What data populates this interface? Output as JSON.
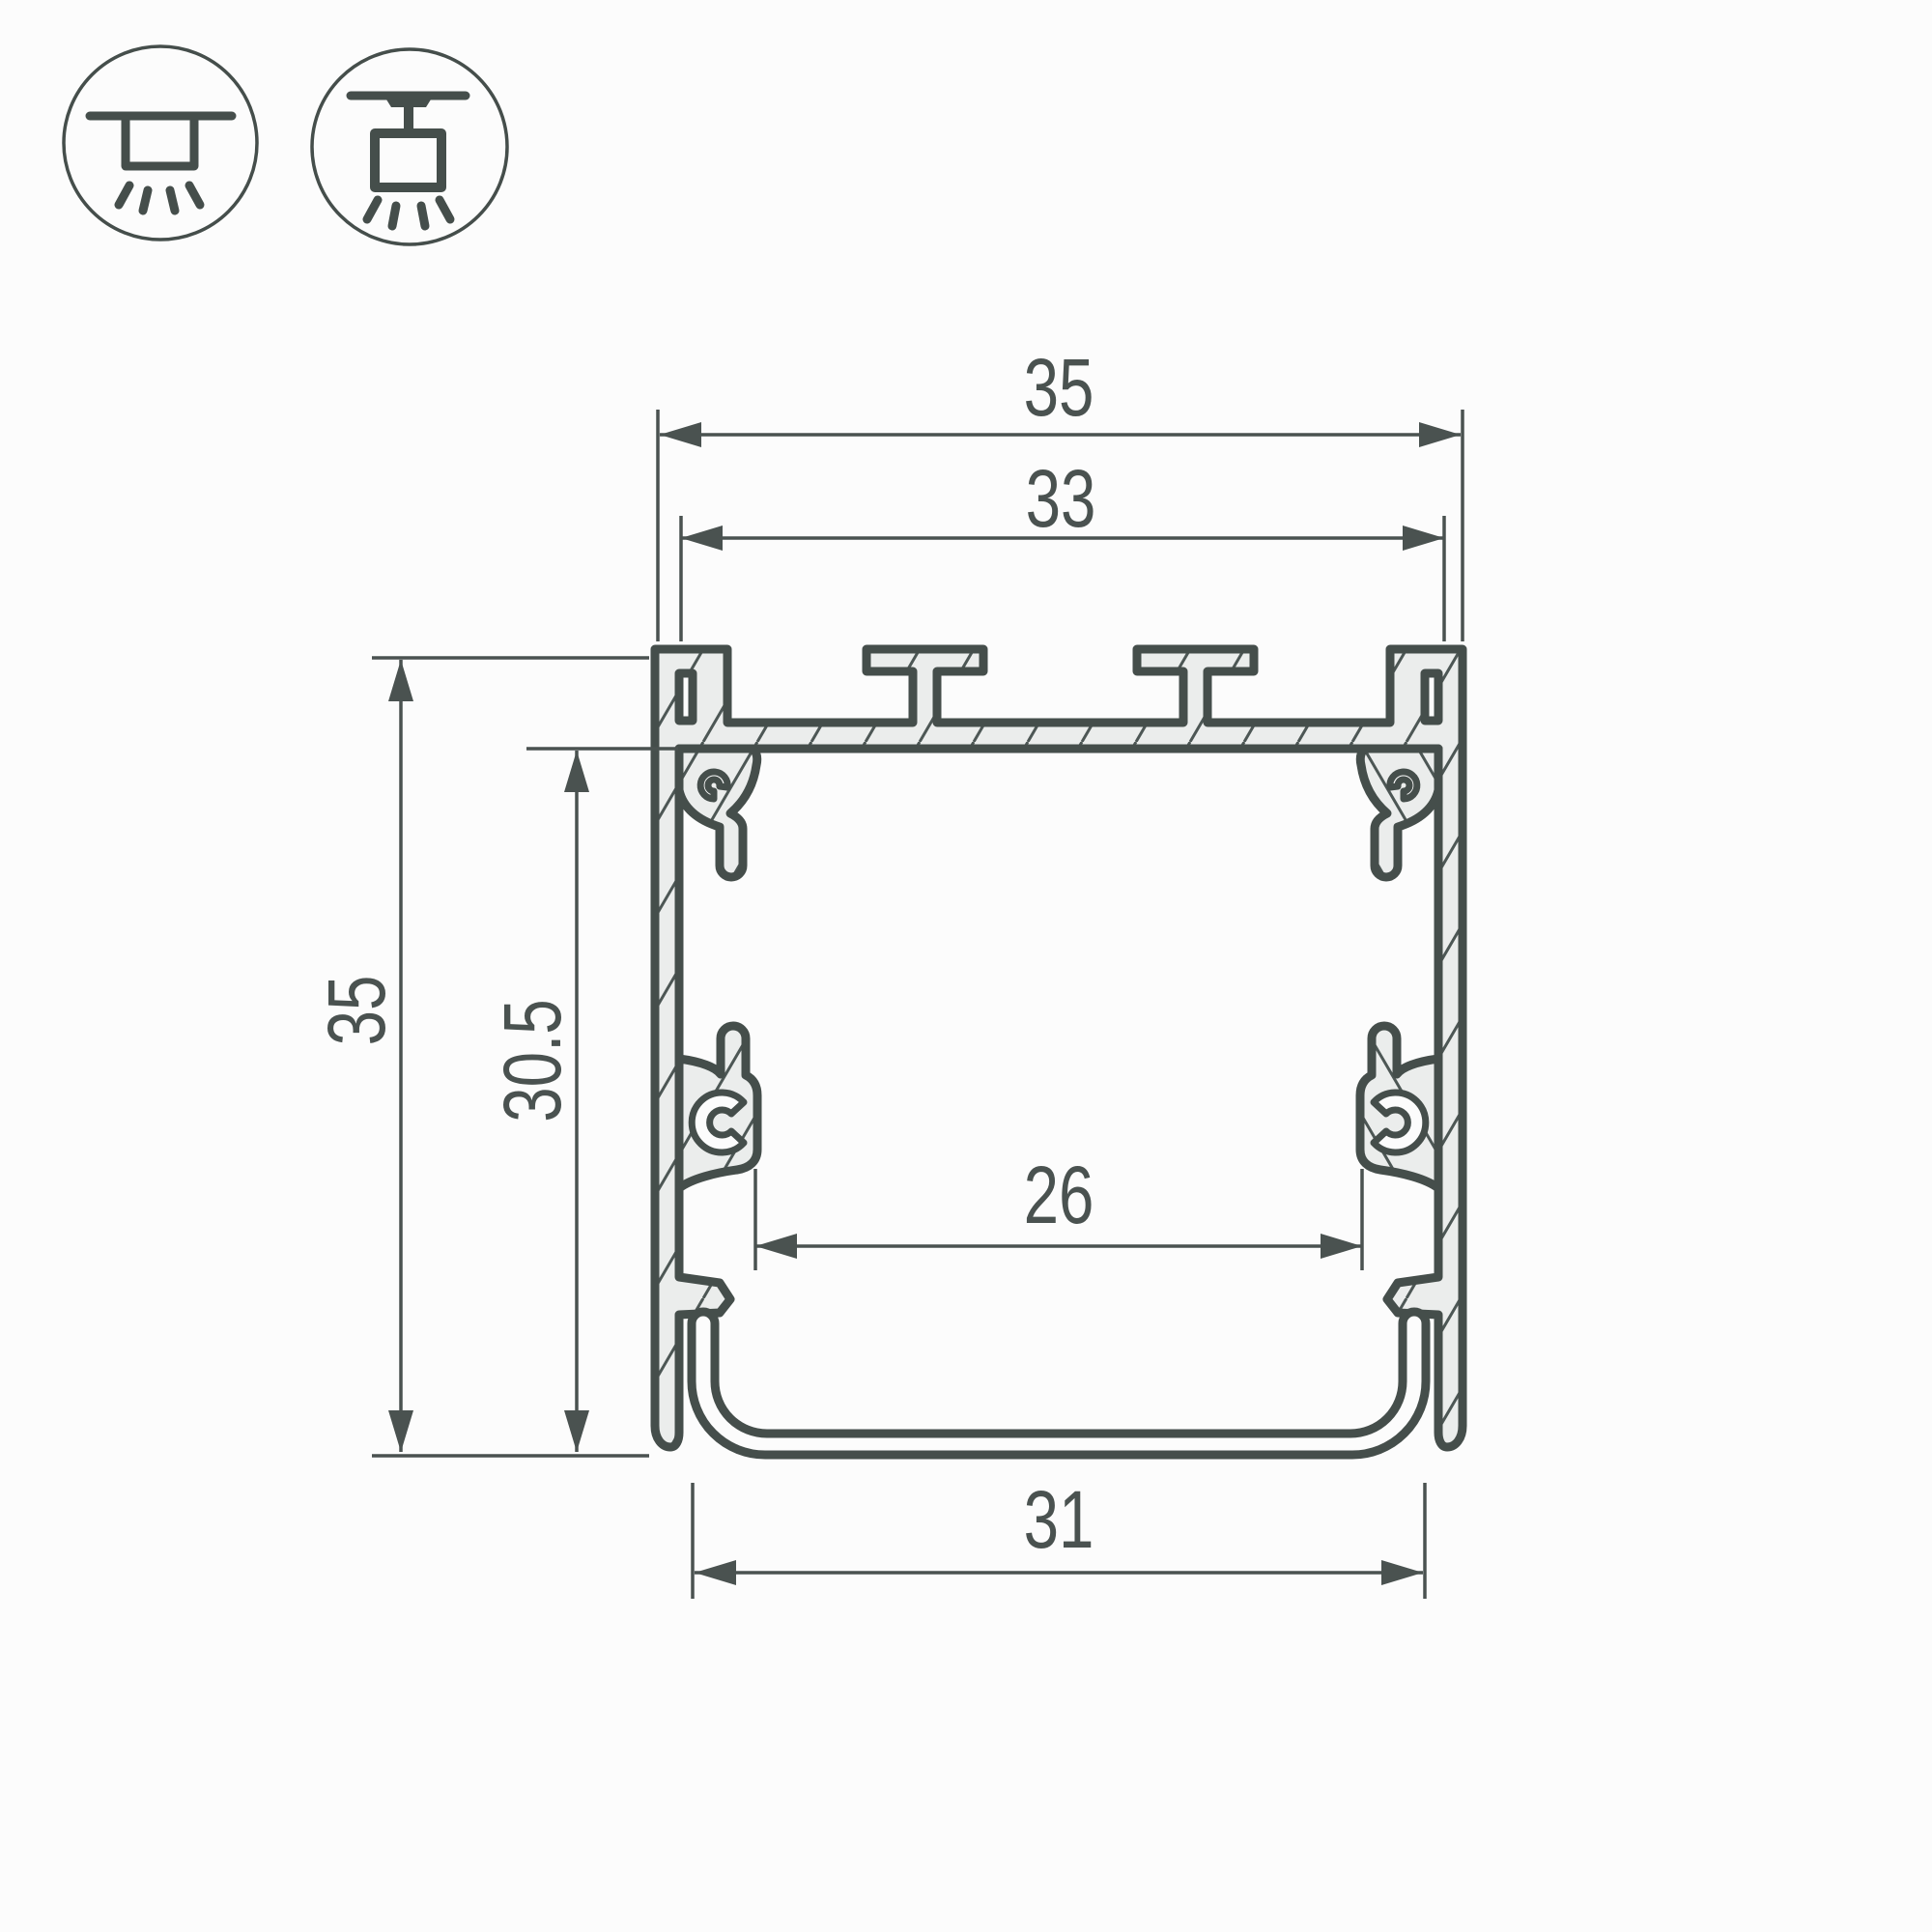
{
  "drawing": {
    "kind": "profile-cross-section-technical-drawing"
  },
  "legend": {
    "icons": [
      {
        "name": "surface-mount-icon"
      },
      {
        "name": "pendant-mount-icon"
      }
    ]
  },
  "dimensions": {
    "overall_width": "35",
    "inner_top_width": "33",
    "overall_height": "35",
    "inner_height": "30.5",
    "inner_bottom_width": "26",
    "bottom_width": "31"
  },
  "colors": {
    "line": "#454e4b",
    "metal_fill": "#ebedec",
    "hatch_line": "#4d5755",
    "text": "#4a5250",
    "background": "#fcfcfc"
  }
}
